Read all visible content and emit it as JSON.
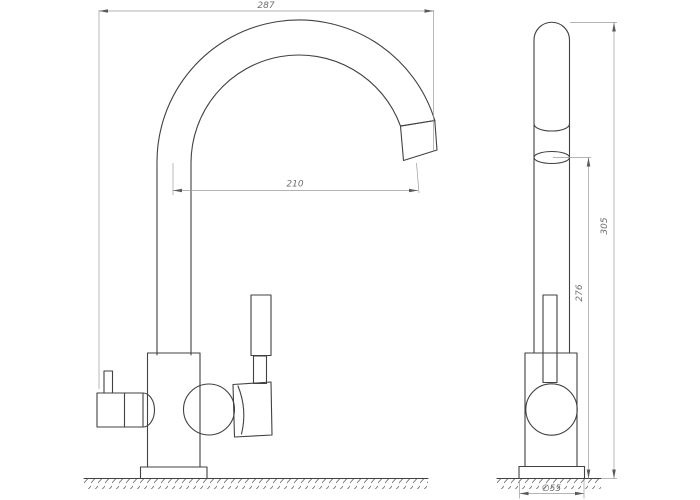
{
  "drawing": {
    "dimensions": {
      "front_width": "287",
      "spout_reach": "210",
      "outlet_height": "276",
      "total_height": "305",
      "base_diameter": "∅55"
    }
  }
}
